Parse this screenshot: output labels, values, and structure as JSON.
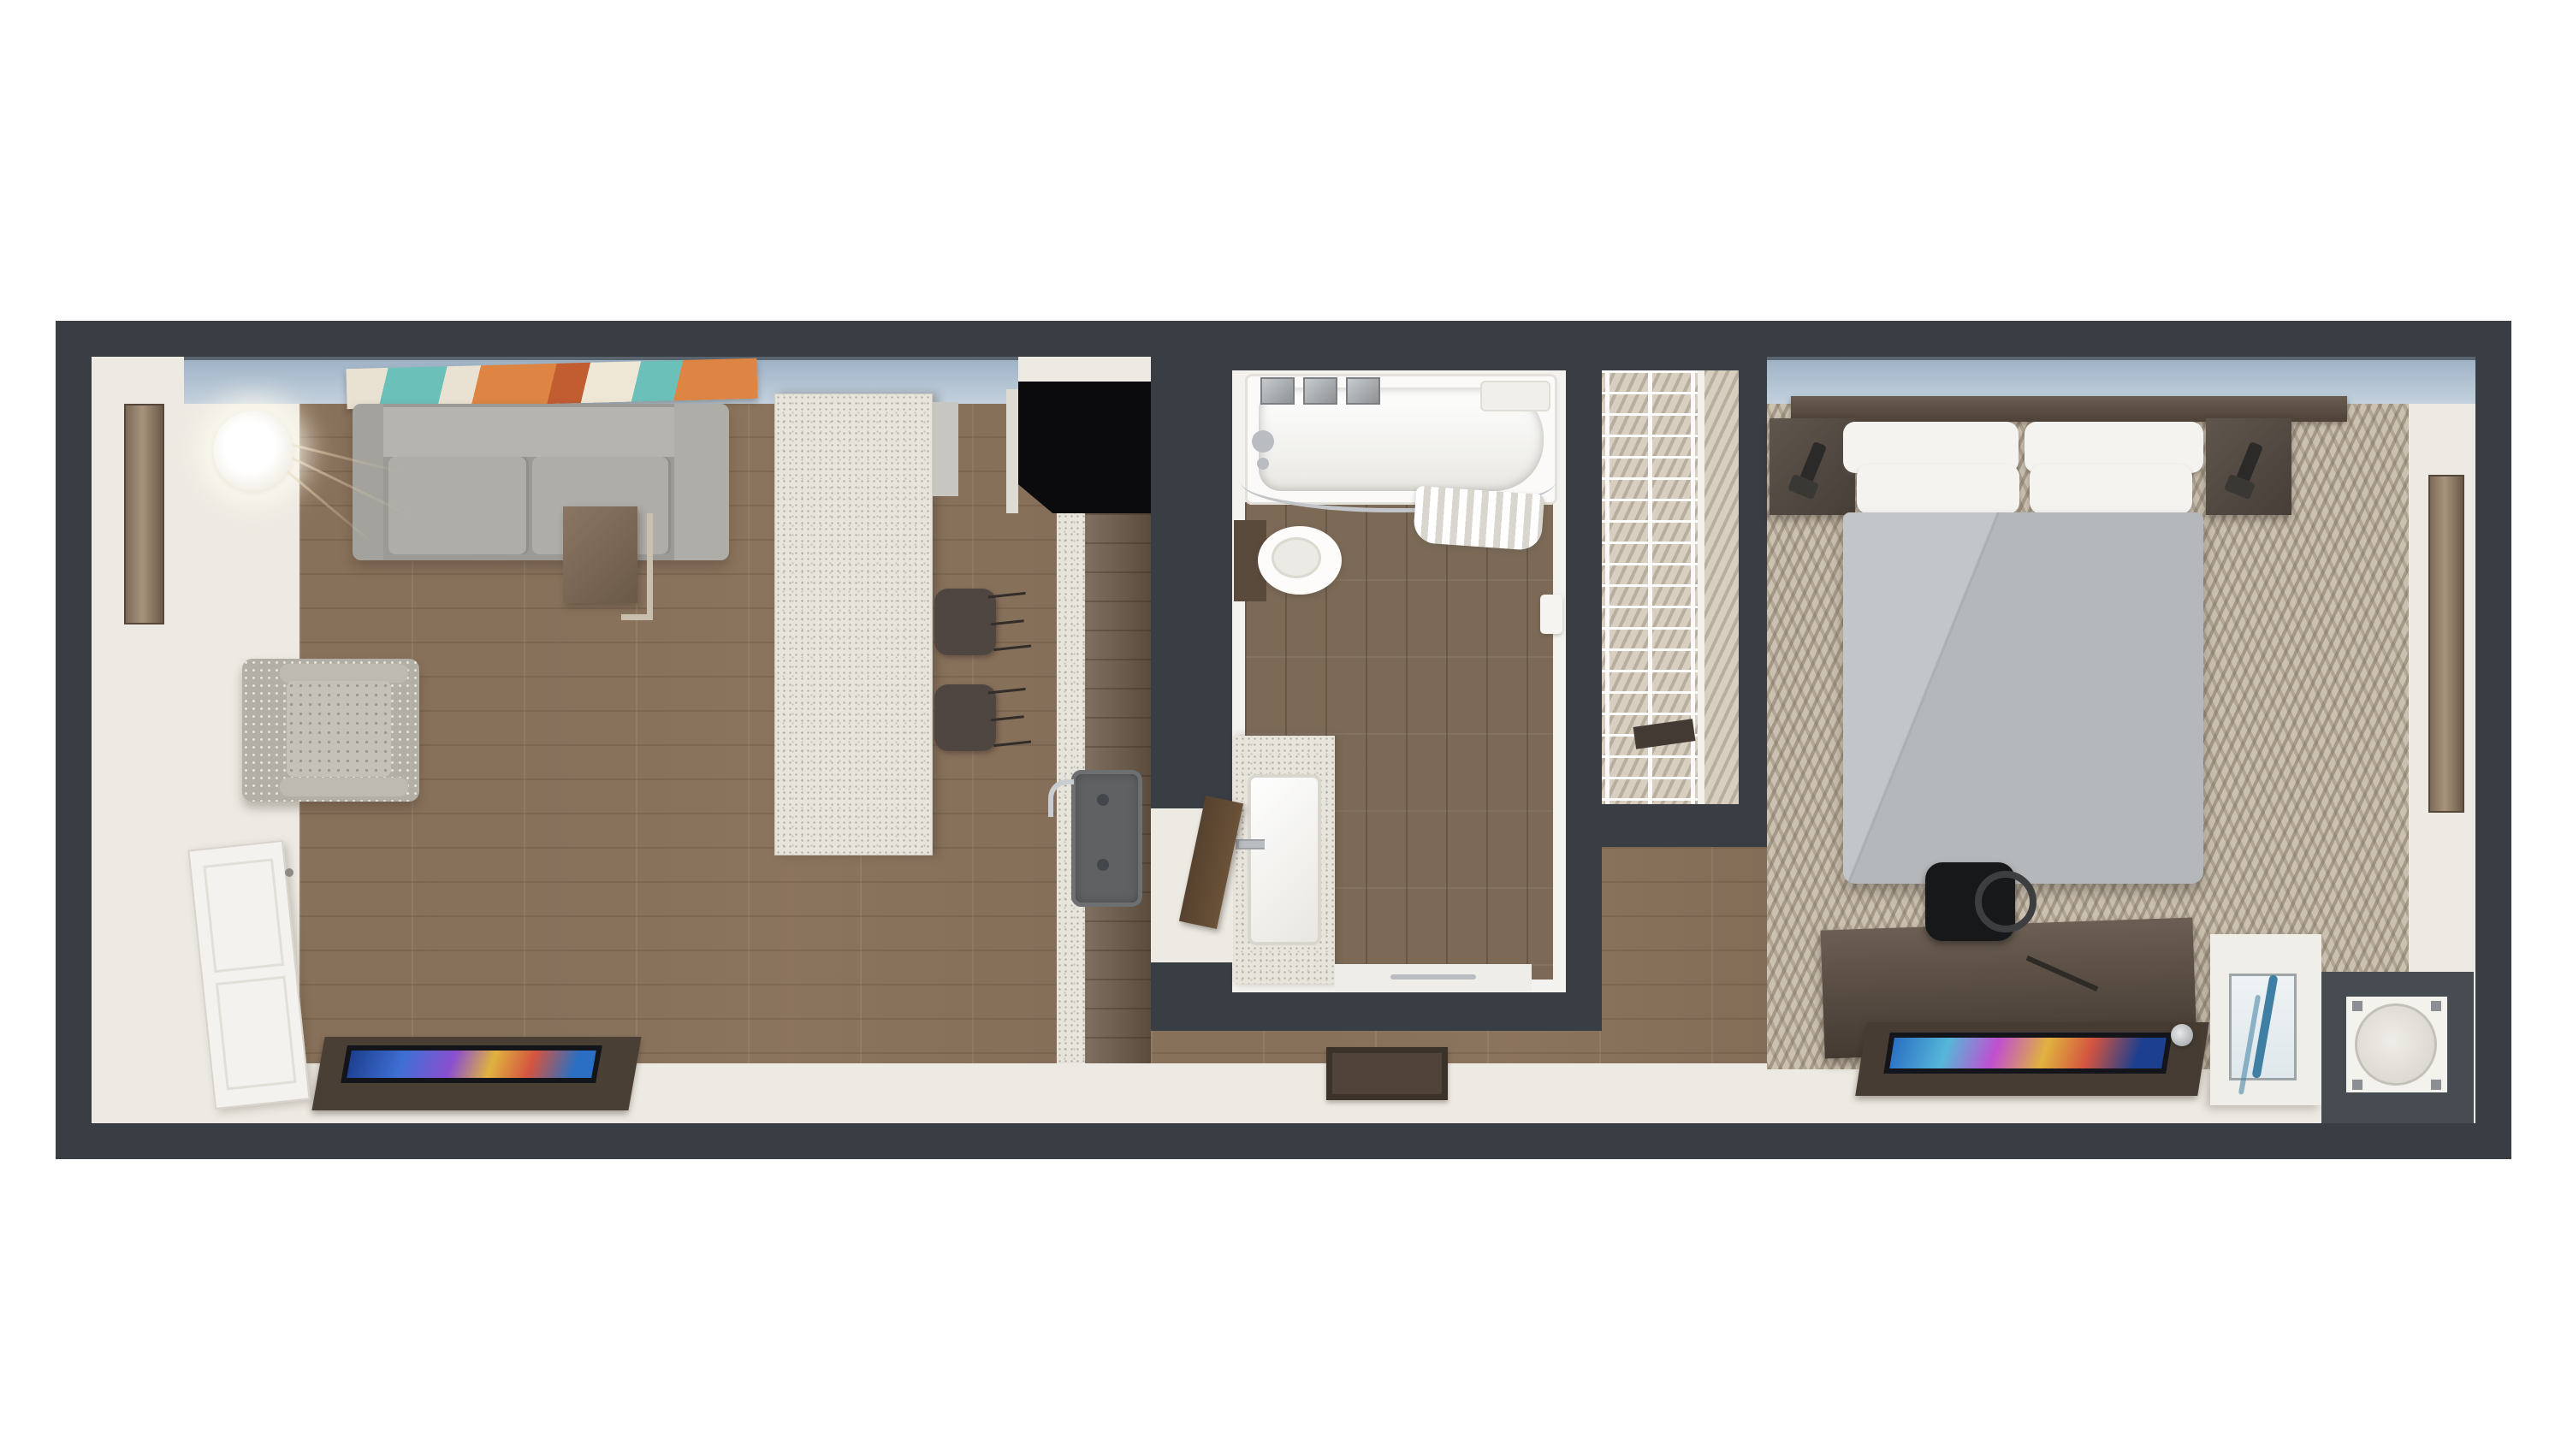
{
  "image_type": "3d-floor-plan-rendering",
  "scene": {
    "description": "Top-down 3D dollhouse rendering of a studio hotel suite",
    "orientation": "landscape strip with white margins above and below"
  },
  "palette": {
    "page_background": "#ffffff",
    "wall_dark": "#383e44",
    "interior_cream": "#edeae3",
    "wood_floor": "#8d7761",
    "bath_floor": "#7c6a57",
    "carpet": "#cbc1b1",
    "carpet_pattern": "#7e705d",
    "window_band_blue": "#b0c2d2",
    "sofa_gray": "#9b9a95",
    "bed_duvet_gray": "#b5b8bb",
    "pillow_white": "#f4f3f0",
    "counter_speckle": "#e7e4dc",
    "cabinet_walnut": "#6e5c4b",
    "furniture_dark_wood": "#4e4238",
    "refrigerator_black": "#0b0b0e",
    "chrome": "#b9bcc0",
    "art_teal": "#6cc0ba",
    "art_orange": "#de8544",
    "bench_art_blue": "#3e7fa3"
  },
  "labels": {
    "plan": "Studio suite floor plan",
    "living_room": "Living room",
    "kitchen": "Kitchen",
    "bathroom": "Bathroom",
    "closet": "Closet with wire shelving",
    "bedroom": "Bedroom",
    "sofa": "Gray sectional sofa",
    "armchair": "Patterned accent armchair",
    "floor_lamp": "Glowing globe floor lamp",
    "side_table": "Wood C-side-table",
    "wall_art": "Abstract wall art in teal and orange",
    "living_tv": "Flat screen TV on media console",
    "entry_door": "Open white entry door",
    "island": "Kitchen island with quartz top",
    "bar_stools": "Two dark bar stools",
    "refrigerator": "Black refrigerator",
    "kitchen_counter": "Walnut kitchen counter",
    "kitchen_sink": "Undermount kitchen sink with faucet",
    "bathtub": "Bathtub with curved shower rod and curtain",
    "toilet": "Toilet",
    "vanity": "Vanity with rectangular sink",
    "bathroom_door": "Open bathroom door",
    "door_mat": "Entry door mat",
    "bed": "King bed with white pillows and gray duvet",
    "headboard": "Wood headboard panel",
    "nightstands": "Floating nightstands with reading lamps",
    "desk": "Dark wood desk and dresser",
    "desk_chair": "Black desk chair",
    "bedroom_tv": "Flat screen TV on dresser",
    "bench": "Upholstered bench with blue abstract art",
    "fridge_niche": "Cabinet niche with round appliance top",
    "mirrors": "Full-length wall mirrors",
    "windows": "Window band along top wall"
  },
  "rooms": [
    {
      "name": "living-room",
      "floor": "wood-plank",
      "items": [
        "sofa",
        "armchair",
        "floor-lamp",
        "side-table",
        "wall-art",
        "tv-console",
        "entry-door",
        "wall-mirror"
      ]
    },
    {
      "name": "kitchen",
      "floor": "wood-plank",
      "items": [
        "island",
        "bar-stool",
        "bar-stool",
        "refrigerator",
        "counter",
        "sink",
        "faucet"
      ]
    },
    {
      "name": "bathroom",
      "floor": "wood-tile",
      "items": [
        "bathtub",
        "shower-curtain",
        "chrome-trays",
        "toilet",
        "vanity-sink",
        "towel-bar",
        "door",
        "paper-holder"
      ]
    },
    {
      "name": "closet",
      "floor": "carpet",
      "items": [
        "wire-shelving"
      ]
    },
    {
      "name": "bedroom",
      "floor": "patterned-carpet",
      "items": [
        "king-bed",
        "headboard",
        "nightstand",
        "nightstand",
        "reading-lamp",
        "reading-lamp",
        "desk",
        "desk-chair",
        "tv-on-dresser",
        "bench",
        "blue-art",
        "appliance-niche",
        "wall-mirror",
        "door-mat"
      ]
    }
  ]
}
